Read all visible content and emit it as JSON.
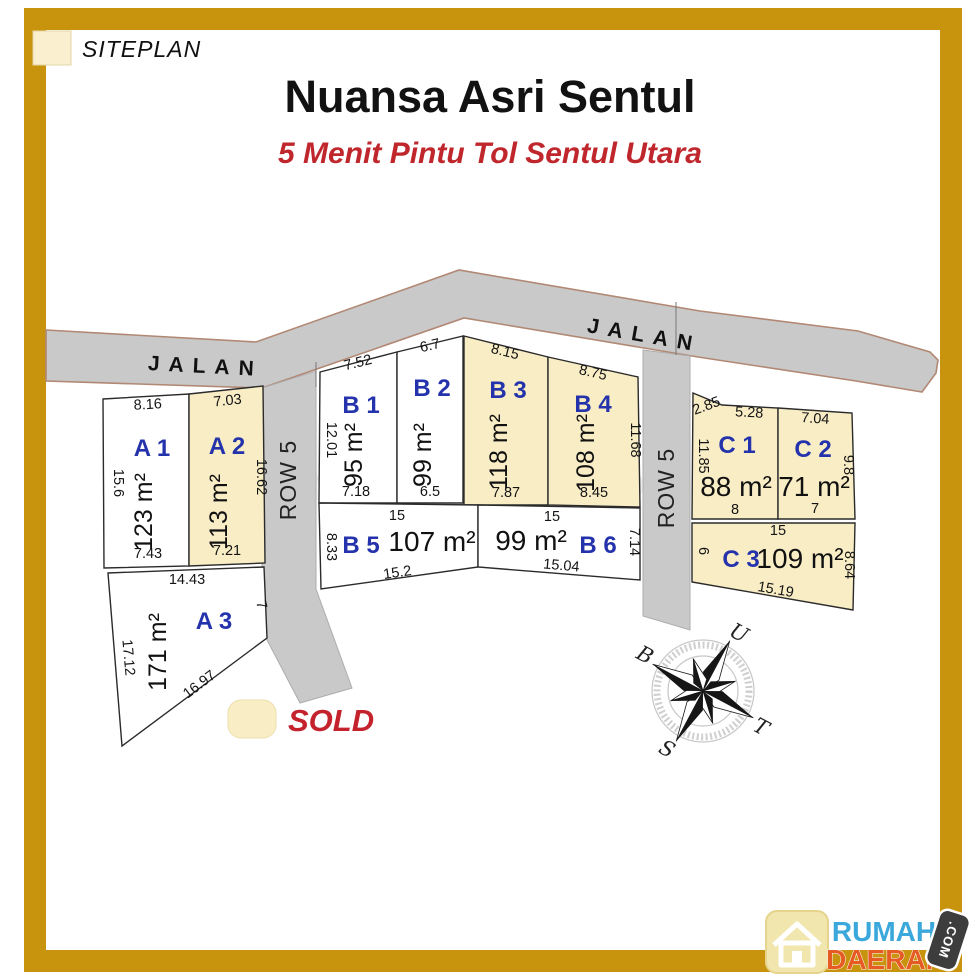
{
  "header": {
    "title": "Nuansa Asri Sentul",
    "subtitle": "5 Menit Pintu Tol Sentul Utara"
  },
  "legend": {
    "siteplan_label": "SITEPLAN",
    "sold_label": "SOLD"
  },
  "colors": {
    "frame_gold": "#C8940E",
    "sold_fill": "#F9EDC6",
    "road_gray": "#C9C9C9",
    "plot_label_blue": "#2433AB",
    "accent_red": "#C0272D"
  },
  "roads": {
    "jalan_left": "JALAN",
    "jalan_right": "JALAN",
    "row5_left": "ROW 5",
    "row5_right": "ROW 5"
  },
  "compass": {
    "north": "U",
    "east": "T",
    "south": "S",
    "west": "B"
  },
  "watermark": "rumah123.com",
  "logo": {
    "line1": "RUMAH",
    "line2": "DAERAH",
    "tld": ".COM",
    "icon": "home-icon"
  },
  "plots": [
    {
      "id": "A1",
      "label": "A 1",
      "area": "123 m²",
      "sold": false,
      "dims": [
        "8.16",
        "15.6",
        "7.43"
      ]
    },
    {
      "id": "A2",
      "label": "A 2",
      "area": "113 m²",
      "sold": true,
      "dims": [
        "7.03",
        "16.62",
        "7.21"
      ]
    },
    {
      "id": "A3",
      "label": "A 3",
      "area": "171 m²",
      "sold": false,
      "dims": [
        "14.43",
        "17.12",
        "16.97",
        "7"
      ]
    },
    {
      "id": "B1",
      "label": "B 1",
      "area": "95 m²",
      "sold": false,
      "dims": [
        "7.52",
        "12.01",
        "7.18",
        "14.26"
      ]
    },
    {
      "id": "B2",
      "label": "B 2",
      "area": "99 m²",
      "sold": false,
      "dims": [
        "6.7",
        "6.5",
        "16.06"
      ]
    },
    {
      "id": "B3",
      "label": "B 3",
      "area": "118 m²",
      "sold": true,
      "dims": [
        "8.15",
        "7.87",
        "13.6"
      ]
    },
    {
      "id": "B4",
      "label": "B 4",
      "area": "108 m²",
      "sold": true,
      "dims": [
        "8.75",
        "8.45",
        "11.68"
      ]
    },
    {
      "id": "B5",
      "label": "B 5",
      "area": "107 m²",
      "sold": false,
      "dims": [
        "15",
        "8.33",
        "15.2",
        "6"
      ]
    },
    {
      "id": "B6",
      "label": "B 6",
      "area": "99 m²",
      "sold": false,
      "dims": [
        "15",
        "15.04",
        "7.14"
      ]
    },
    {
      "id": "C1",
      "label": "C 1",
      "area": "88 m²",
      "sold": true,
      "dims": [
        "2.85",
        "5.28",
        "11.85",
        "8"
      ]
    },
    {
      "id": "C2",
      "label": "C 2",
      "area": "71 m²",
      "sold": true,
      "dims": [
        "7.04",
        "9.8",
        "7"
      ]
    },
    {
      "id": "C3",
      "label": "C 3",
      "area": "109 m²",
      "sold": true,
      "dims": [
        "15",
        "6",
        "8.64",
        "15.19"
      ]
    }
  ]
}
